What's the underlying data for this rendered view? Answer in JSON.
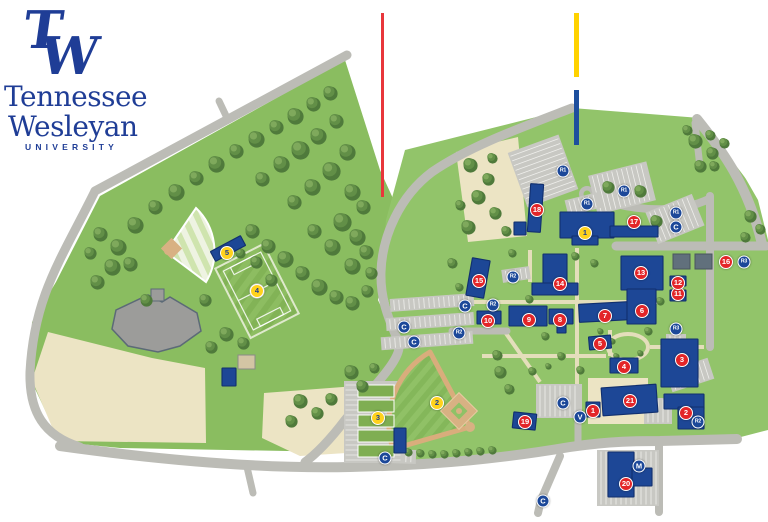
{
  "logo": {
    "monogram_t": "T",
    "monogram_w": "W",
    "name_line1": "Tennessee",
    "name_line2": "Wesleyan",
    "name_line3": "UNIVERSITY"
  },
  "colors": {
    "brand_blue": "#1f3d96",
    "building_blue": "#1d4796",
    "building_border": "#112f6e",
    "marker_red": "#e32528",
    "marker_yellow": "#ffd21c",
    "marker_blue": "#1c4899",
    "grass_west": "#8abd60",
    "grass_core": "#92c46a",
    "road_gray": "#bcbcb6",
    "callout_red": "#e8363b",
    "callout_yellow": "#ffd200",
    "callout_blue": "#1d4f9e"
  },
  "map": {
    "building_markers": [
      {
        "number": "1",
        "x": 593,
        "y": 411
      },
      {
        "number": "2",
        "x": 686,
        "y": 413
      },
      {
        "number": "3",
        "x": 682,
        "y": 360
      },
      {
        "number": "4",
        "x": 624,
        "y": 367
      },
      {
        "number": "5",
        "x": 600,
        "y": 344
      },
      {
        "number": "6",
        "x": 642,
        "y": 311
      },
      {
        "number": "7",
        "x": 605,
        "y": 316
      },
      {
        "number": "8",
        "x": 560,
        "y": 320
      },
      {
        "number": "9",
        "x": 529,
        "y": 320
      },
      {
        "number": "10",
        "x": 488,
        "y": 321
      },
      {
        "number": "11",
        "x": 678,
        "y": 294
      },
      {
        "number": "12",
        "x": 678,
        "y": 283
      },
      {
        "number": "13",
        "x": 641,
        "y": 273
      },
      {
        "number": "14",
        "x": 560,
        "y": 284
      },
      {
        "number": "15",
        "x": 479,
        "y": 281
      },
      {
        "number": "16",
        "x": 726,
        "y": 262
      },
      {
        "number": "17",
        "x": 634,
        "y": 222
      },
      {
        "number": "18",
        "x": 537,
        "y": 210
      },
      {
        "number": "19",
        "x": 525,
        "y": 422
      },
      {
        "number": "20",
        "x": 626,
        "y": 484
      },
      {
        "number": "21",
        "x": 630,
        "y": 401
      }
    ],
    "athletic_markers": [
      {
        "number": "1",
        "x": 585,
        "y": 233
      },
      {
        "number": "2",
        "x": 437,
        "y": 403
      },
      {
        "number": "3",
        "x": 378,
        "y": 418
      },
      {
        "number": "4",
        "x": 257,
        "y": 291
      },
      {
        "number": "5",
        "x": 227,
        "y": 253
      }
    ],
    "parking_markers": [
      {
        "label": "R1",
        "x": 563,
        "y": 171
      },
      {
        "label": "R1",
        "x": 624,
        "y": 191
      },
      {
        "label": "R1",
        "x": 587,
        "y": 204
      },
      {
        "label": "R1",
        "x": 676,
        "y": 213
      },
      {
        "label": "C",
        "x": 676,
        "y": 227
      },
      {
        "label": "R2",
        "x": 513,
        "y": 277
      },
      {
        "label": "C",
        "x": 465,
        "y": 306
      },
      {
        "label": "R2",
        "x": 493,
        "y": 305
      },
      {
        "label": "C",
        "x": 404,
        "y": 327
      },
      {
        "label": "C",
        "x": 414,
        "y": 342
      },
      {
        "label": "R2",
        "x": 459,
        "y": 333
      },
      {
        "label": "R3",
        "x": 744,
        "y": 262
      },
      {
        "label": "R3",
        "x": 676,
        "y": 329
      },
      {
        "label": "C",
        "x": 563,
        "y": 403
      },
      {
        "label": "V",
        "x": 580,
        "y": 417
      },
      {
        "label": "C",
        "x": 385,
        "y": 458
      },
      {
        "label": "C",
        "x": 543,
        "y": 501
      },
      {
        "label": "M",
        "x": 639,
        "y": 466
      },
      {
        "label": "R2",
        "x": 698,
        "y": 422
      }
    ],
    "callout_lines": [
      {
        "name": "red-callout",
        "color": "#e8363b",
        "x": 381,
        "y": 13,
        "height": 184,
        "width": 3
      },
      {
        "name": "yellow-callout",
        "color": "#ffd200",
        "x": 574,
        "y": 13,
        "height": 64,
        "width": 5
      },
      {
        "name": "blue-callout",
        "color": "#1d4f9e",
        "x": 574,
        "y": 90,
        "height": 55,
        "width": 5
      }
    ]
  }
}
